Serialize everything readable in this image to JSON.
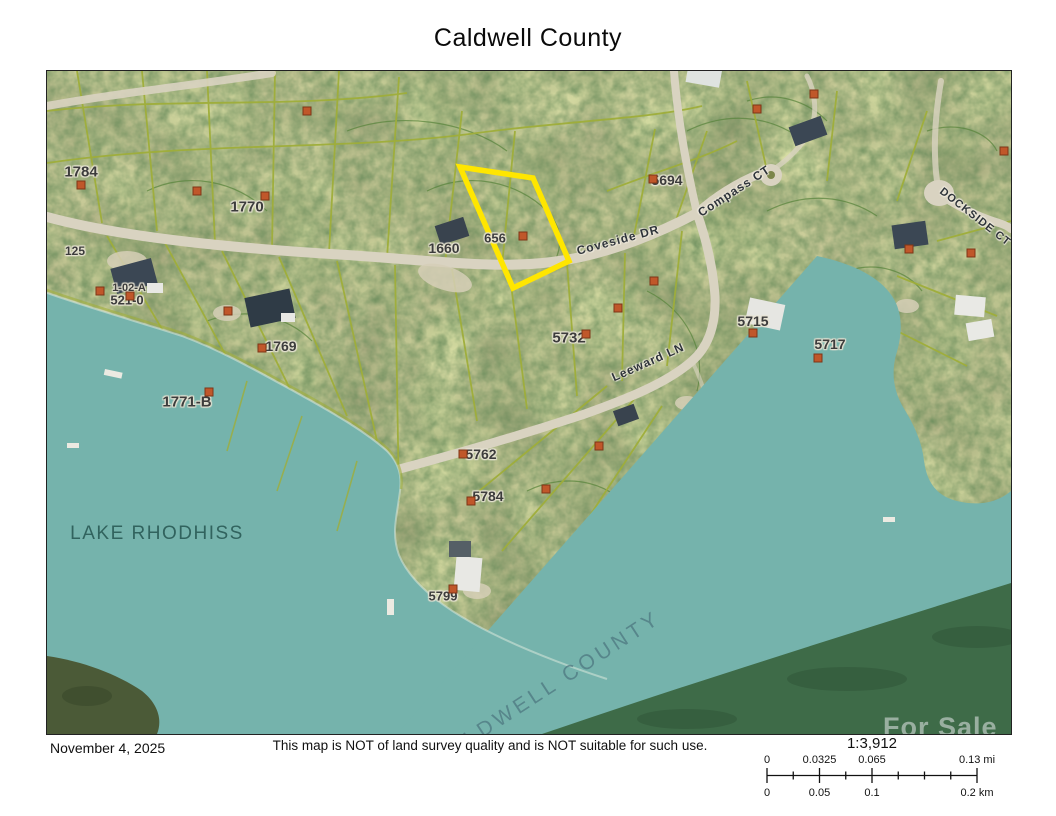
{
  "page": {
    "title": "Caldwell County",
    "date": "November 4, 2025",
    "disclaimer": "This map is NOT of land survey quality and is NOT suitable for such use."
  },
  "scalebar": {
    "ratio": "1:3,912",
    "mi_labels": [
      "0",
      "0.0325",
      "0.065",
      "0.13"
    ],
    "mi_unit": "mi",
    "km_labels": [
      "0",
      "0.05",
      "0.1",
      "0.2"
    ],
    "km_unit": "km",
    "positions_pct": [
      0,
      25,
      50,
      100
    ]
  },
  "map": {
    "lake_label": {
      "text": "LAKE RHODHISS",
      "x": 110,
      "y": 463,
      "size": 19,
      "spacing": 1.5,
      "color": "#2e5f5a",
      "rotate": 0,
      "opacity": 0.95
    },
    "county_label": {
      "text": "CALDWELL COUNTY",
      "x": 500,
      "y": 618,
      "size": 21,
      "spacing": 4,
      "color": "#4e7880",
      "rotate": -33,
      "opacity": 0.75
    },
    "watermark": "For Sale",
    "highlight_parcel": {
      "points": "413,96 486,107 522,190 466,217",
      "color": "#ffe600"
    },
    "road_labels": [
      {
        "text": "Coveside DR",
        "x": 571,
        "y": 169,
        "rotate": -15,
        "size": 12
      },
      {
        "text": "Compass CT",
        "x": 687,
        "y": 120,
        "rotate": -33,
        "size": 12
      },
      {
        "text": "Leeward LN",
        "x": 601,
        "y": 291,
        "rotate": -24,
        "size": 12
      },
      {
        "text": "DOCKSIDE CT",
        "x": 928,
        "y": 146,
        "rotate": 38,
        "size": 11
      }
    ],
    "parcel_labels": [
      {
        "text": "1784",
        "x": 34,
        "y": 101,
        "size": 15
      },
      {
        "text": "1770",
        "x": 200,
        "y": 136,
        "size": 15
      },
      {
        "text": "125",
        "x": 28,
        "y": 180,
        "size": 12
      },
      {
        "text": "1-02-A",
        "x": 82,
        "y": 217,
        "size": 11
      },
      {
        "text": "521-0",
        "x": 80,
        "y": 229,
        "size": 13
      },
      {
        "text": "1660",
        "x": 397,
        "y": 177,
        "size": 14
      },
      {
        "text": "656",
        "x": 448,
        "y": 167,
        "size": 13
      },
      {
        "text": "5694",
        "x": 620,
        "y": 109,
        "size": 14
      },
      {
        "text": "1769",
        "x": 234,
        "y": 275,
        "size": 14
      },
      {
        "text": "1771-B",
        "x": 140,
        "y": 331,
        "size": 15
      },
      {
        "text": "5732",
        "x": 522,
        "y": 267,
        "size": 15
      },
      {
        "text": "5715",
        "x": 706,
        "y": 250,
        "size": 14
      },
      {
        "text": "5717",
        "x": 783,
        "y": 273,
        "size": 14
      },
      {
        "text": "5762",
        "x": 434,
        "y": 383,
        "size": 14
      },
      {
        "text": "5784",
        "x": 441,
        "y": 425,
        "size": 14
      },
      {
        "text": "5799",
        "x": 396,
        "y": 525,
        "size": 13
      }
    ],
    "markers": [
      [
        34,
        114
      ],
      [
        150,
        120
      ],
      [
        218,
        125
      ],
      [
        260,
        40
      ],
      [
        606,
        108
      ],
      [
        476,
        165
      ],
      [
        53,
        220
      ],
      [
        83,
        225
      ],
      [
        181,
        240
      ],
      [
        215,
        277
      ],
      [
        162,
        321
      ],
      [
        607,
        210
      ],
      [
        571,
        237
      ],
      [
        539,
        263
      ],
      [
        706,
        262
      ],
      [
        771,
        287
      ],
      [
        416,
        383
      ],
      [
        424,
        430
      ],
      [
        552,
        375
      ],
      [
        499,
        418
      ],
      [
        406,
        518
      ],
      [
        862,
        178
      ],
      [
        924,
        182
      ],
      [
        957,
        80
      ],
      [
        710,
        38
      ],
      [
        767,
        23
      ]
    ],
    "colors": {
      "lake": "#75b3ac",
      "far_shore": "#3e6b48",
      "road": "#d9d3c1",
      "parcel_line": "#9fae3a",
      "contour": "#57833b",
      "highlight": "#ffe600",
      "marker": "#c0572a"
    }
  }
}
